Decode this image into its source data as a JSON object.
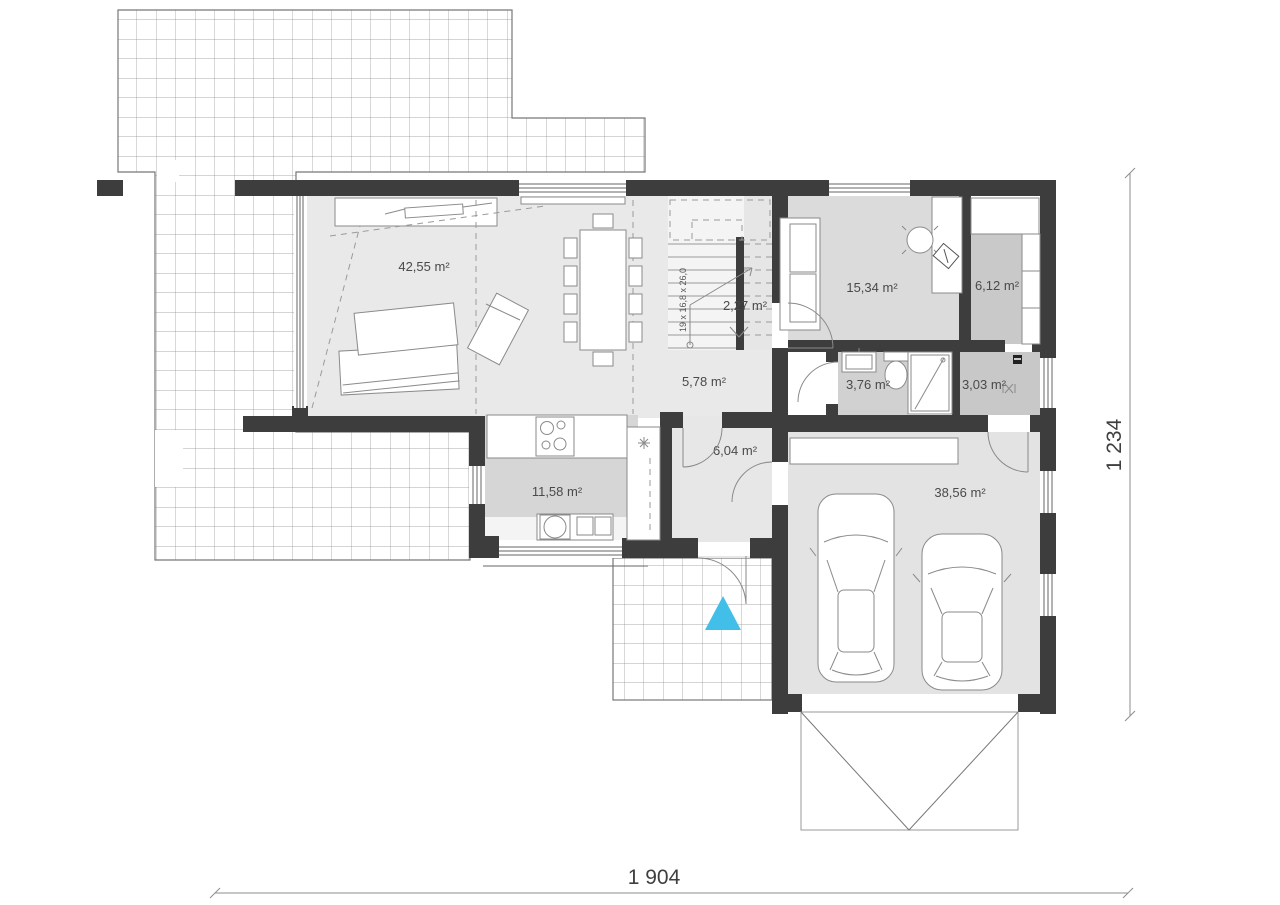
{
  "plan": {
    "rooms": {
      "living": {
        "area_label": "42,55 m²"
      },
      "stairwell": {
        "area_label": "2,27 m²"
      },
      "hall": {
        "area_label": "5,78 m²"
      },
      "office": {
        "area_label": "15,34 m²"
      },
      "wardrobe": {
        "area_label": "6,12 m²"
      },
      "bathroom": {
        "area_label": "3,76 m²"
      },
      "utility": {
        "area_label": "3,03 m²"
      },
      "kitchen": {
        "area_label": "11,58 m²"
      },
      "vestibule": {
        "area_label": "6,04 m²"
      },
      "garage": {
        "area_label": "38,56 m²"
      }
    },
    "stairs_note": "19 x 16,8 x 26,0",
    "dimensions": {
      "bottom": "1 904",
      "right": "1 234"
    },
    "colors": {
      "wall": "#3d3d3d",
      "entrance_marker": "#41bfe8"
    }
  }
}
